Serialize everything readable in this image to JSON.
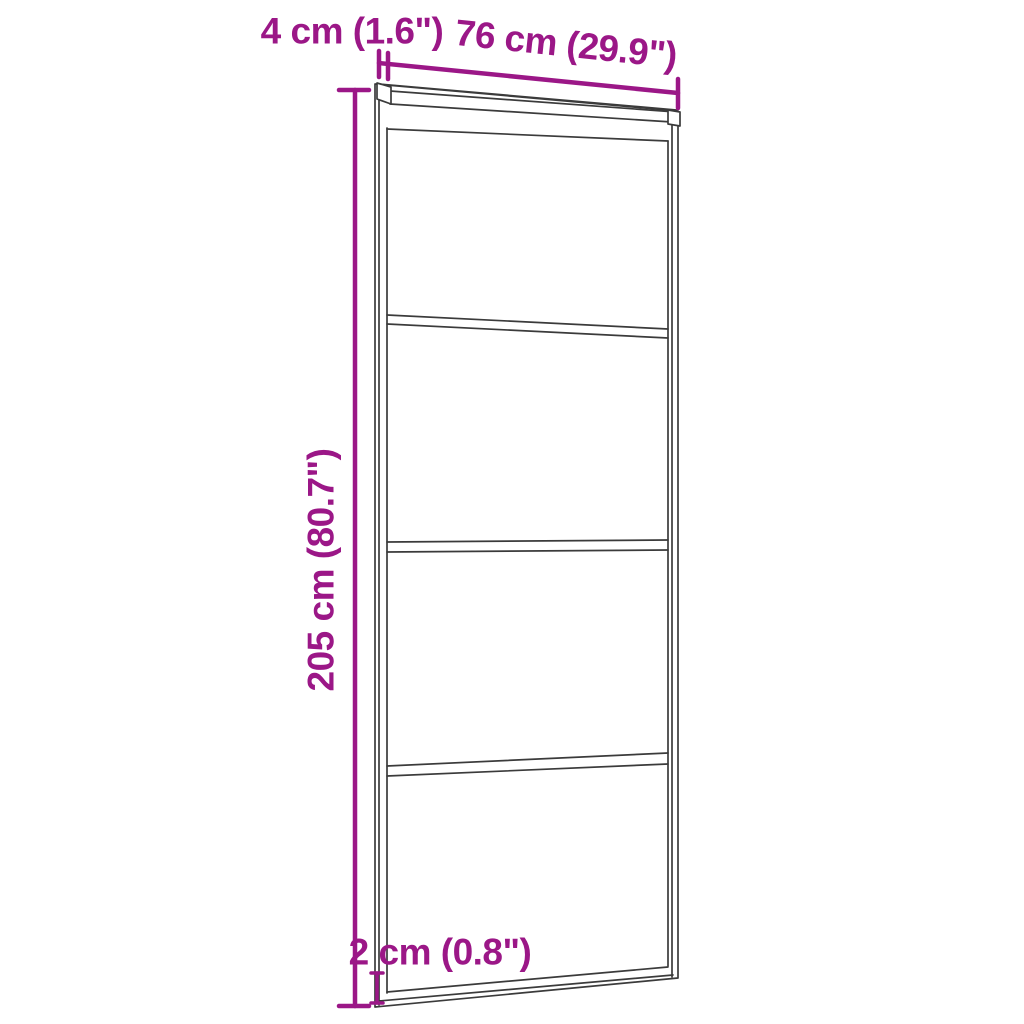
{
  "image": {
    "title": "Sliding door dimension diagram",
    "background_color": "#ffffff"
  },
  "diagram": {
    "type": "product-dimension-diagram",
    "product": "Sliding glass door with aluminium frame, 4 glass panels, perspective line drawing",
    "panel_count": 4,
    "style": {
      "dimension_color": "#9B1787",
      "outline_color": "#3B3B3B"
    },
    "dimensions": {
      "height": {
        "value_cm": 205,
        "value_in": 80.7,
        "label": "205 cm (80.7\")"
      },
      "width": {
        "value_cm": 76,
        "value_in": 29.9,
        "label": "76 cm (29.9\")"
      },
      "top_rail": {
        "value_cm": 4,
        "value_in": 1.6,
        "label": "4 cm (1.6\")"
      },
      "bottom_rail": {
        "value_cm": 2,
        "value_in": 0.8,
        "label": "2 cm (0.8\")"
      }
    }
  }
}
